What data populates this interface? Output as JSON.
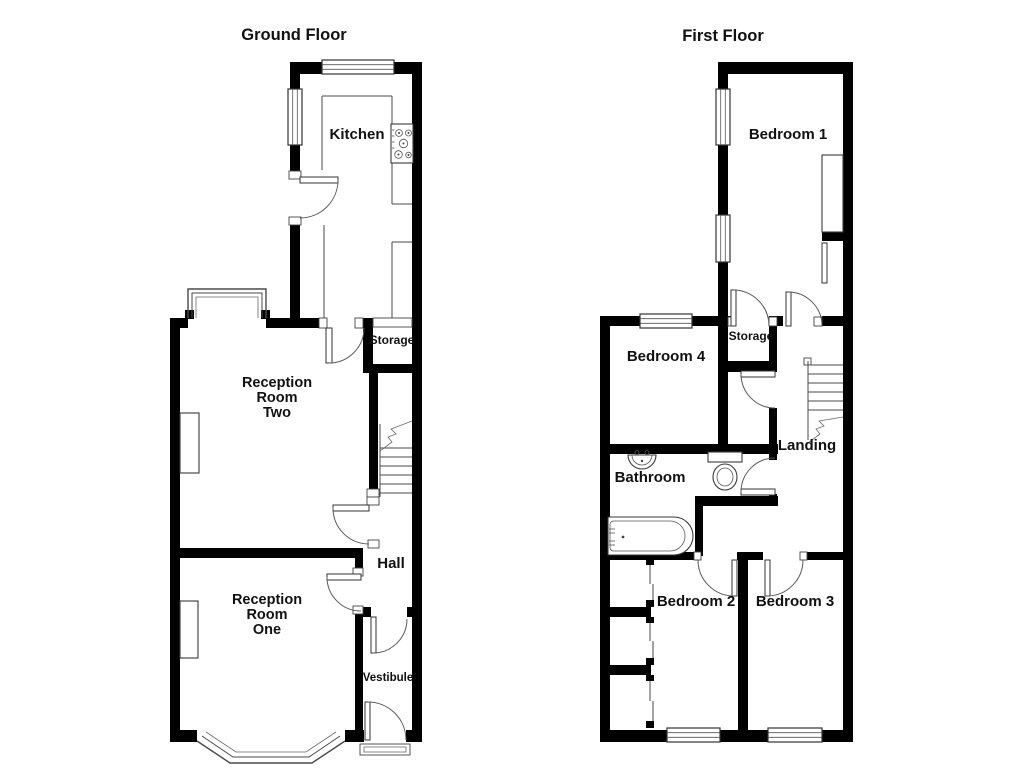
{
  "ground_floor": {
    "title": "Ground Floor",
    "labels": {
      "kitchen": "Kitchen",
      "storage": "Storage",
      "reception_two": [
        "Reception",
        "Room",
        "Two"
      ],
      "hall": "Hall",
      "reception_one": [
        "Reception",
        "Room",
        "One"
      ],
      "vestibule": "Vestibule"
    }
  },
  "first_floor": {
    "title": "First Floor",
    "labels": {
      "bedroom_1": "Bedroom 1",
      "bedroom_4": "Bedroom 4",
      "storage": "Storage",
      "landing": "Landing",
      "bathroom": "Bathroom",
      "bedroom_2": "Bedroom 2",
      "bedroom_3": "Bedroom 3"
    }
  },
  "colors": {
    "wall": "#000000",
    "background": "#ffffff",
    "line": "#4a4a4a",
    "text": "#111111"
  }
}
